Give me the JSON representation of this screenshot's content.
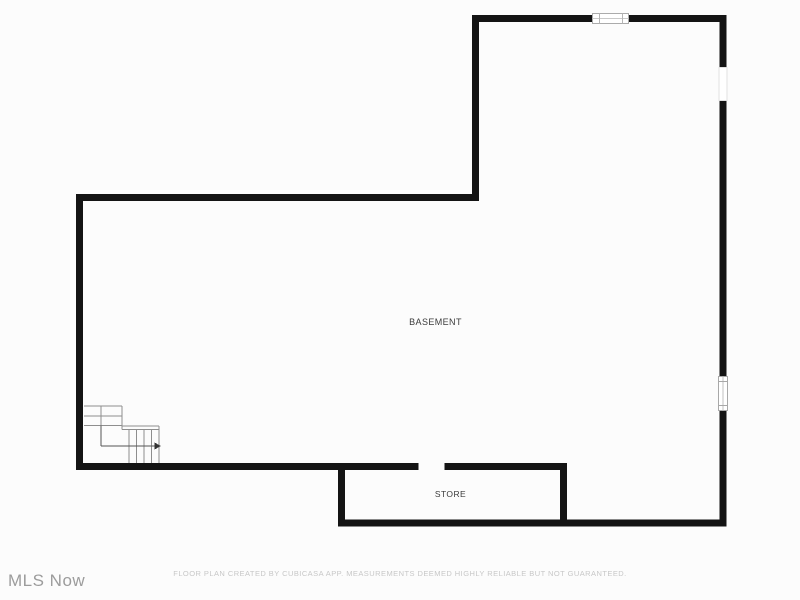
{
  "page": {
    "type": "floor-plan",
    "floor_shown": "BASEMENT"
  },
  "plan": {
    "labels": {
      "basement": "BASEMENT",
      "store": "STORE"
    },
    "feature_icons": [
      "staircase-icon",
      "stair-direction-arrow-icon",
      "window-top-icon",
      "opening-right-upper-icon",
      "window-right-lower-icon",
      "door-opening-store"
    ]
  },
  "footer": {
    "watermark": "MLS Now",
    "disclaimer": "FLOOR PLAN CREATED BY CUBICASA APP. MEASUREMENTS DEEMED HIGHLY RELIABLE BUT NOT GUARANTEED."
  },
  "colors": {
    "background": "#fcfcfc",
    "wall": "#141414",
    "room_label": "#3b3b3b",
    "stair_line": "#8e8e8e",
    "walking_line": "#555555",
    "window_frame": "#a8a8a8",
    "faint_opening_frame": "#e2e2e2",
    "watermark_text": "#9c9c9c",
    "disclaimer_text": "#c7c7c7"
  }
}
